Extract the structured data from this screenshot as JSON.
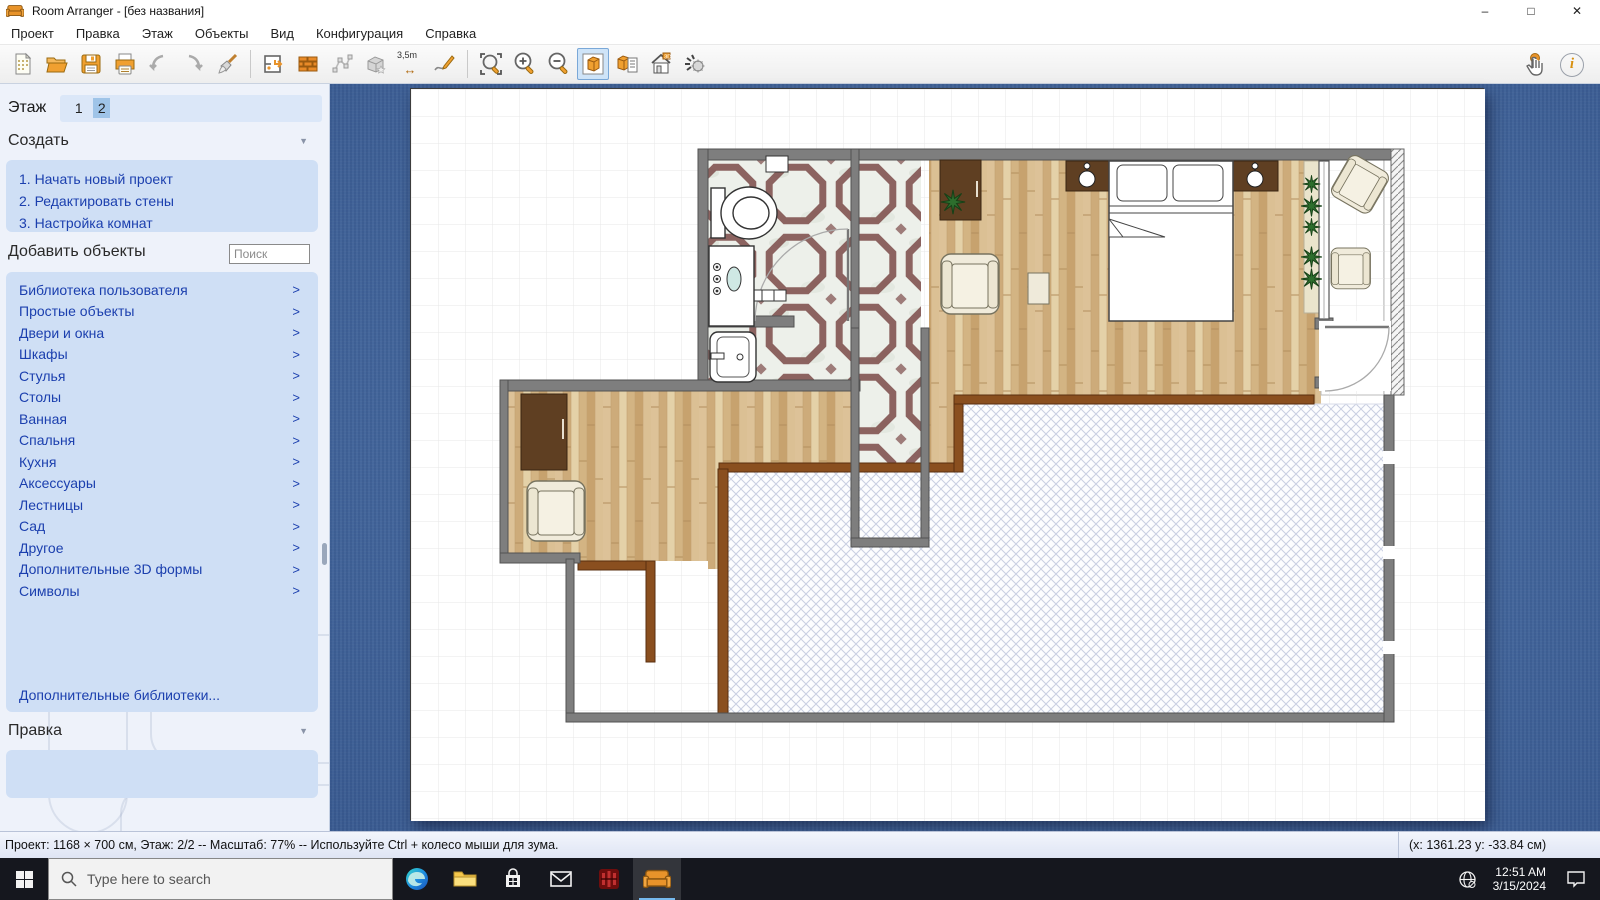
{
  "window": {
    "title": "Room Arranger - [без названия]"
  },
  "icons": {
    "minimize": "–",
    "maximize": "□",
    "close": "✕",
    "chevron": ">",
    "collapse": "▼",
    "measure_arrow": "↔",
    "info": "i"
  },
  "menubar": {
    "items": [
      "Проект",
      "Правка",
      "Этаж",
      "Объекты",
      "Вид",
      "Конфигурация",
      "Справка"
    ]
  },
  "toolbar": {
    "measure_label": "3,5m"
  },
  "sidebar": {
    "floor_label": "Этаж",
    "floor_tabs": [
      "1",
      "2"
    ],
    "active_floor": "2",
    "create_header": "Создать",
    "create_links": [
      "1. Начать новый проект",
      "2. Редактировать стены",
      "3. Настройка комнат"
    ],
    "add_objects_header": "Добавить объекты",
    "search_placeholder": "Поиск",
    "categories": [
      "Библиотека пользователя",
      "Простые объекты",
      "Двери и окна",
      "Шкафы",
      "Стулья",
      "Столы",
      "Ванная",
      "Спальня",
      "Кухня",
      "Аксессуары",
      "Лестницы",
      "Сад",
      "Другое",
      "Дополнительные 3D формы",
      "Символы"
    ],
    "more_libraries": "Дополнительные библиотеки...",
    "edit_header": "Правка"
  },
  "statusbar": {
    "left": "Проект: 1168 × 700 см, Этаж: 2/2 -- Масштаб: 77% -- Используйте Ctrl + колесо мыши для зума.",
    "right": "(x: 1361.23 y: -33.84 см)"
  },
  "taskbar": {
    "search_placeholder": "Type here to search",
    "time": "12:51 AM",
    "date": "3/15/2024"
  },
  "colors": {
    "accent_orange": "#e8932a",
    "selection_blue": "#9fc4e8",
    "link_blue": "#1b3fae",
    "panel_blue": "#cfdff5",
    "canvas_blue": "#3a64a0",
    "wall_gray": "#7e7e7e",
    "wood_tan": "#d6b88a",
    "tile_maroon": "#7b4a48",
    "terrace_hatch": "#c9cfe2",
    "taskbar_dark": "#15171e"
  }
}
